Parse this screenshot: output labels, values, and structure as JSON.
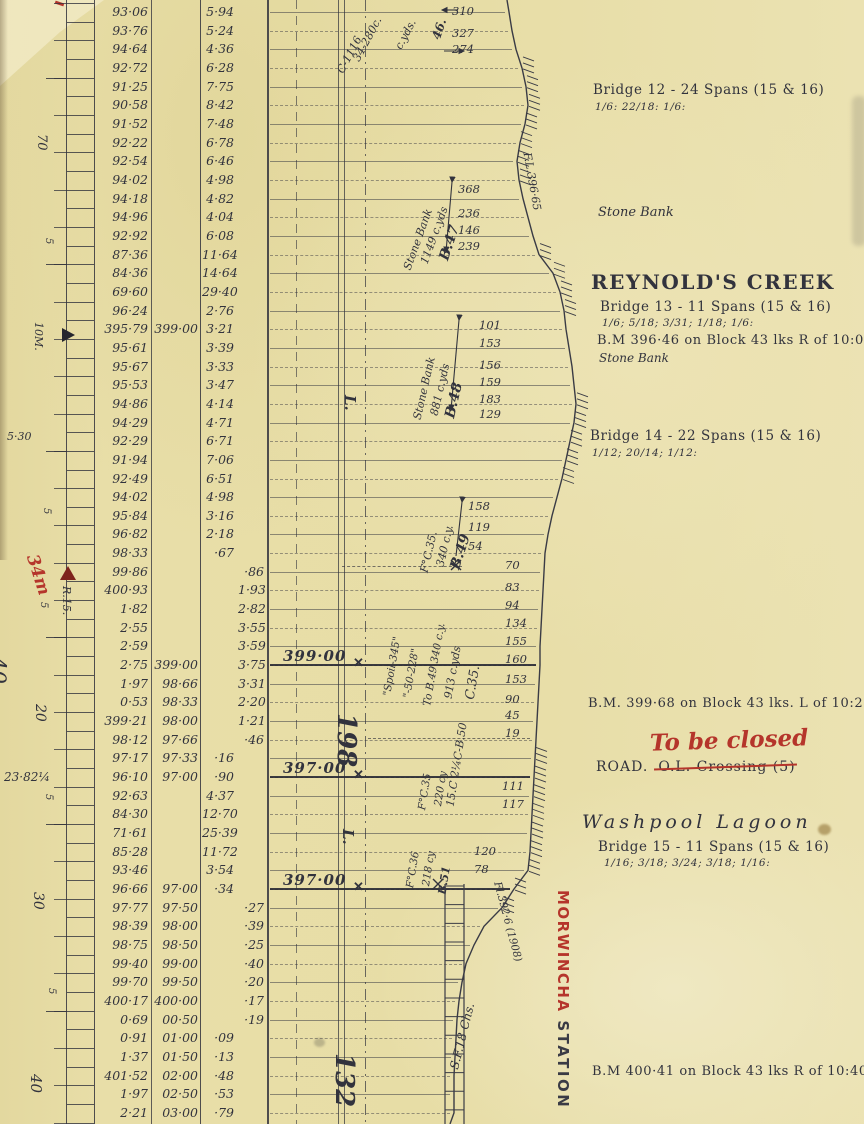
{
  "palette": {
    "paper": "#e8dea8",
    "ink": "#32333d",
    "red": "#b5352b"
  },
  "ruler": {
    "labels": [
      {
        "id": "m70",
        "text": "70"
      },
      {
        "id": "s1",
        "text": "5"
      },
      {
        "id": "mile10",
        "text": "10M."
      },
      {
        "id": "grade530",
        "text": "5·30"
      },
      {
        "id": "s2",
        "text": "5"
      },
      {
        "id": "red34m",
        "text": "34m"
      },
      {
        "id": "r15",
        "text": "R.15."
      },
      {
        "id": "s3",
        "text": "5"
      },
      {
        "id": "m40",
        "text": "40"
      },
      {
        "id": "m20",
        "text": "20"
      },
      {
        "id": "grade2382",
        "text": "23·82¼"
      },
      {
        "id": "s4",
        "text": "5"
      },
      {
        "id": "m30",
        "text": "30"
      },
      {
        "id": "s5",
        "text": "5"
      },
      {
        "id": "m40b",
        "text": "40"
      }
    ]
  },
  "levels": {
    "columns": [
      "ground_level",
      "formation_level",
      "bank_height",
      "cutting_depth"
    ],
    "rows": [
      [
        "93·06",
        "",
        "5·94",
        ""
      ],
      [
        "93·76",
        "",
        "5·24",
        ""
      ],
      [
        "94·64",
        "",
        "4·36",
        ""
      ],
      [
        "92·72",
        "",
        "6·28",
        ""
      ],
      [
        "91·25",
        "",
        "7·75",
        ""
      ],
      [
        "90·58",
        "",
        "8·42",
        ""
      ],
      [
        "91·52",
        "",
        "7·48",
        ""
      ],
      [
        "92·22",
        "",
        "6·78",
        ""
      ],
      [
        "92·54",
        "",
        "6·46",
        ""
      ],
      [
        "94·02",
        "",
        "4·98",
        ""
      ],
      [
        "94·18",
        "",
        "4·82",
        ""
      ],
      [
        "94·96",
        "",
        "4·04",
        ""
      ],
      [
        "92·92",
        "",
        "6·08",
        ""
      ],
      [
        "87·36",
        "",
        "11·64",
        ""
      ],
      [
        "84·36",
        "",
        "14·64",
        ""
      ],
      [
        "69·60",
        "",
        "29·40",
        ""
      ],
      [
        "96·24",
        "",
        "2·76",
        ""
      ],
      [
        "395·79",
        "399·00",
        "3·21",
        ""
      ],
      [
        "95·61",
        "",
        "3·39",
        ""
      ],
      [
        "95·67",
        "",
        "3·33",
        ""
      ],
      [
        "95·53",
        "",
        "3·47",
        ""
      ],
      [
        "94·86",
        "",
        "4·14",
        ""
      ],
      [
        "94·29",
        "",
        "4·71",
        ""
      ],
      [
        "92·29",
        "",
        "6·71",
        ""
      ],
      [
        "91·94",
        "",
        "7·06",
        ""
      ],
      [
        "92·49",
        "",
        "6·51",
        ""
      ],
      [
        "94·02",
        "",
        "4·98",
        ""
      ],
      [
        "95·84",
        "",
        "3·16",
        ""
      ],
      [
        "96·82",
        "",
        "2·18",
        ""
      ],
      [
        "98·33",
        "",
        "·67",
        ""
      ],
      [
        "99·86",
        "",
        "",
        "·86"
      ],
      [
        "400·93",
        "",
        "",
        "1·93"
      ],
      [
        "1·82",
        "",
        "",
        "2·82"
      ],
      [
        "2·55",
        "",
        "",
        "3·55"
      ],
      [
        "2·59",
        "",
        "",
        "3·59"
      ],
      [
        "2·75",
        "399·00",
        "",
        "3·75"
      ],
      [
        "1·97",
        "98·66",
        "",
        "3·31"
      ],
      [
        "0·53",
        "98·33",
        "",
        "2·20"
      ],
      [
        "399·21",
        "98·00",
        "",
        "1·21"
      ],
      [
        "98·12",
        "97·66",
        "",
        "·46"
      ],
      [
        "97·17",
        "97·33",
        "·16",
        ""
      ],
      [
        "96·10",
        "97·00",
        "·90",
        ""
      ],
      [
        "92·63",
        "",
        "4·37",
        ""
      ],
      [
        "84·30",
        "",
        "12·70",
        ""
      ],
      [
        "71·61",
        "",
        "25·39",
        ""
      ],
      [
        "85·28",
        "",
        "11·72",
        ""
      ],
      [
        "93·46",
        "",
        "3·54",
        ""
      ],
      [
        "96·66",
        "97·00",
        "·34",
        ""
      ],
      [
        "97·77",
        "97·50",
        "",
        "·27"
      ],
      [
        "98·39",
        "98·00",
        "",
        "·39"
      ],
      [
        "98·75",
        "98·50",
        "",
        "·25"
      ],
      [
        "99·40",
        "99·00",
        "",
        "·40"
      ],
      [
        "99·70",
        "99·50",
        "",
        "·20"
      ],
      [
        "400·17",
        "400·00",
        "",
        "·17"
      ],
      [
        "0·69",
        "00·50",
        "",
        "·19"
      ],
      [
        "0·91",
        "01·00",
        "·09",
        ""
      ],
      [
        "1·37",
        "01·50",
        "·13",
        ""
      ],
      [
        "401·52",
        "02·00",
        "·48",
        ""
      ],
      [
        "1·97",
        "02·50",
        "·53",
        ""
      ],
      [
        "2·21",
        "03·00",
        "·79",
        ""
      ]
    ]
  },
  "grade_marks": [
    {
      "row": 35,
      "text": "399·00"
    },
    {
      "row": 41,
      "text": "397·00"
    },
    {
      "row": 47,
      "text": "397·00"
    }
  ],
  "profile_numbers": [
    {
      "group": "approach",
      "values": [
        "310",
        "327",
        "274"
      ]
    },
    {
      "group": "B.47",
      "values": [
        "368",
        "236",
        "146",
        "239"
      ]
    },
    {
      "group": "B.48",
      "values": [
        "101",
        "153",
        "156",
        "159",
        "183",
        "129"
      ]
    },
    {
      "group": "B.49",
      "values": [
        "158",
        "119",
        "54"
      ]
    },
    {
      "group": "C.35",
      "values": [
        "70",
        "83",
        "94",
        "134",
        "155",
        "160",
        "153",
        "90",
        "45",
        "19"
      ]
    },
    {
      "group": "B.50",
      "values": [
        "111",
        "117"
      ]
    },
    {
      "group": "F.C.36",
      "values": [
        "120",
        "78"
      ]
    }
  ],
  "diagonal_labels": [
    {
      "id": "frag46",
      "text": "46."
    },
    {
      "id": "frag1",
      "text": "34-280c."
    },
    {
      "id": "frag2",
      "text": "C-1116"
    },
    {
      "id": "frag3",
      "text": "c.yds."
    },
    {
      "id": "b47",
      "text": "B.47"
    },
    {
      "id": "b47qty",
      "text": "1149 c.yds"
    },
    {
      "id": "b47bank",
      "text": "Stone Bank"
    },
    {
      "id": "b48",
      "text": "B.48"
    },
    {
      "id": "b48qty",
      "text": "881 c.yds"
    },
    {
      "id": "b48bank",
      "text": "Stone Bank"
    },
    {
      "id": "b49",
      "text": "B.49"
    },
    {
      "id": "b49qty",
      "text": "340 c.y."
    },
    {
      "id": "fc35a",
      "text": "F°C.35."
    },
    {
      "id": "c35qty",
      "text": "913 c.yds"
    },
    {
      "id": "c35",
      "text": "C.35."
    },
    {
      "id": "tob49",
      "text": "To B.49 340 c.y."
    },
    {
      "id": "n50228",
      "text": "\"-50-228\""
    },
    {
      "id": "spoil",
      "text": "\"Spoil-345\""
    },
    {
      "id": "b50",
      "text": "15.C 2¼C-B.50"
    },
    {
      "id": "b50qty",
      "text": "220 cy"
    },
    {
      "id": "fc35b",
      "text": "F°C.35"
    },
    {
      "id": "fc36",
      "text": "F°C.36"
    },
    {
      "id": "fc36qty",
      "text": "218 cy"
    },
    {
      "id": "b51",
      "text": "B.51"
    },
    {
      "id": "sf18",
      "text": "S.F.18 Chs."
    },
    {
      "id": "floodUpper",
      "text": "F.L.396·65"
    },
    {
      "id": "floodLower",
      "text": "Fl.392·6 (1908)"
    },
    {
      "id": "L1",
      "text": "L."
    },
    {
      "id": "L2",
      "text": "L."
    },
    {
      "id": "big198",
      "text": "198"
    },
    {
      "id": "big132",
      "text": "132"
    }
  ],
  "annotations": {
    "bridge12": {
      "line1": "Bridge 12 - 24 Spans (15 & 16)",
      "line2": "1/6: 22/18: 1/6:"
    },
    "stone_bank_1": "Stone Bank",
    "reynolds_creek": {
      "title": "REYNOLD'S CREEK",
      "line1": "Bridge 13 - 11 Spans (15 & 16)",
      "line2": "1/6; 5/18; 3/31; 1/18; 1/6:",
      "bm": "B.M 396·46 on Block 43 lks R of 10:0·00",
      "note": "Stone Bank"
    },
    "bridge14": {
      "line1": "Bridge 14 - 22 Spans (15 & 16)",
      "line2": "1/12; 20/14; 1/12:"
    },
    "bm_399": "B.M. 399·68 on Block 43 lks. L of 10:20·00",
    "road_closure": {
      "stamp": "To be closed",
      "road": "ROAD.",
      "struck": "O.L. Crossing (5)"
    },
    "washpool": {
      "title": "Washpool Lagoon",
      "line1": "Bridge 15 - 11 Spans (15 & 16)",
      "line2": "1/16; 3/18; 3/24; 3/18; 1/16:"
    },
    "station": {
      "name": "MORWINCHA",
      "word2": "STATION"
    },
    "bm_400": "B.M 400·41 on Block 43 lks R of 10:40·00"
  }
}
